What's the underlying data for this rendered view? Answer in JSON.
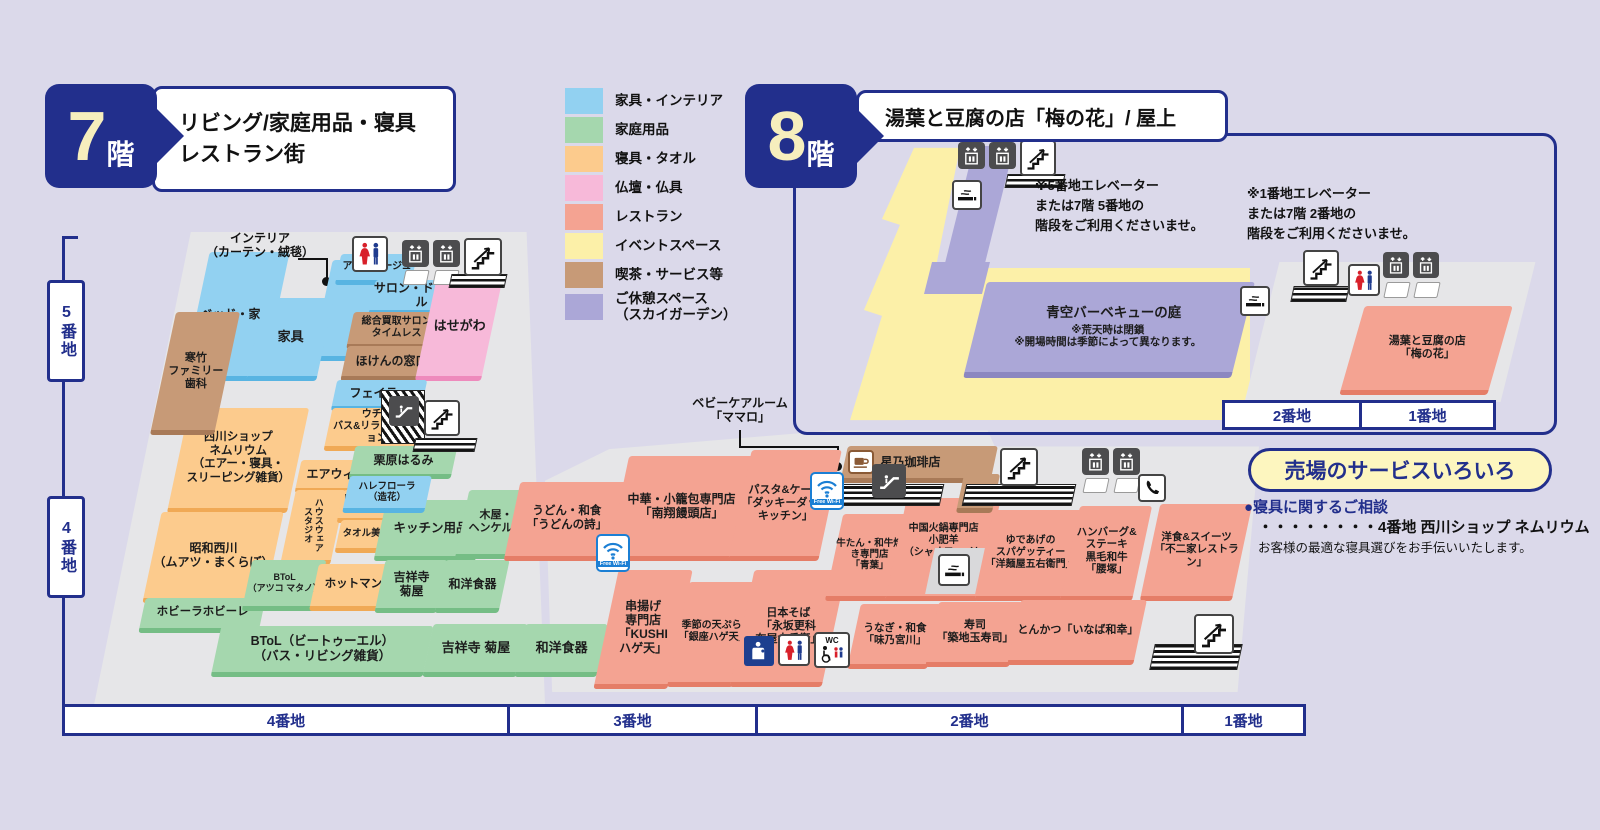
{
  "floor7": {
    "badge": {
      "number": "7",
      "suffix": "階"
    },
    "title_lines": [
      "リビング/家庭用品・寝具",
      "レストラン街"
    ],
    "zones_left": [
      "5番地",
      "4番地"
    ],
    "scale": [
      "4番地",
      "3番地",
      "2番地",
      "1番地"
    ],
    "labels": {
      "interior": [
        "インテリア",
        "（カーテン・絨毯）"
      ],
      "babycare": [
        "ベビーケアルーム",
        "「ママロ」"
      ]
    },
    "shops": [
      {
        "lines": [
          "ベッド・家具"
        ]
      },
      {
        "lines": [
          "寒竹",
          "ファミリー",
          "歯科"
        ]
      },
      {
        "lines": [
          "家具"
        ]
      },
      {
        "lines": [
          "アミブルージュ"
        ]
      },
      {
        "lines": [
          "サロン・ド・アール"
        ]
      },
      {
        "lines": [
          "総合買取サロン",
          "タイムレス"
        ]
      },
      {
        "lines": [
          "ほけんの窓口"
        ]
      },
      {
        "lines": [
          "はせがわ"
        ]
      },
      {
        "lines": [
          "フェイラー"
        ]
      },
      {
        "lines": [
          "ウチノ",
          "バス&リラクゼーション"
        ]
      },
      {
        "lines": [
          "西川ショップ",
          "ネムリウム",
          "（エアー・寝具・",
          "スリーピング雑貨）"
        ]
      },
      {
        "lines": [
          "エアウィーヴ"
        ]
      },
      {
        "lines": [
          "ハウスウェア",
          "スタジオ"
        ]
      },
      {
        "lines": [
          "ロフテー枕工房"
        ]
      },
      {
        "lines": [
          "タオル美術館"
        ]
      },
      {
        "lines": [
          "栗原はるみ"
        ]
      },
      {
        "lines": [
          "ハレフローラ",
          "（造花）"
        ]
      },
      {
        "lines": [
          "キッチン用品"
        ]
      },
      {
        "lines": [
          "木屋・",
          "ヘンケルス"
        ]
      },
      {
        "lines": [
          "昭和西川",
          "（ムアツ・まくらぼ）"
        ]
      },
      {
        "lines": [
          "ホビーラホビーレ"
        ]
      },
      {
        "lines": [
          "BToL",
          "（アツコ マタノ）"
        ]
      },
      {
        "lines": [
          "ホットマン"
        ]
      },
      {
        "lines": [
          "吉祥寺",
          "菊屋"
        ]
      },
      {
        "lines": [
          "和洋食器"
        ]
      },
      {
        "lines": [
          "BToL（ビートゥーエル）",
          "（バス・リビング雑貨）"
        ]
      },
      {
        "lines": [
          "吉祥寺 菊屋"
        ]
      },
      {
        "lines": [
          "和洋食器"
        ]
      },
      {
        "lines": [
          "うどん・和食",
          "「うどんの詩」"
        ]
      },
      {
        "lines": [
          "中華・小籠包専門店",
          "「南翔饅頭店」"
        ]
      },
      {
        "lines": [
          "パスタ&ケーキ",
          "「ダッキーダック",
          "キッチン」"
        ]
      },
      {
        "lines": [
          "串揚げ",
          "専門店",
          "「KUSHI",
          "ハゲ天」"
        ]
      },
      {
        "lines": [
          "季節の天ぷら",
          "「銀座ハゲ天」"
        ]
      },
      {
        "lines": [
          "日本そば",
          "「永坂更科",
          "布屋太兵衛」"
        ]
      },
      {
        "lines": [
          "牛たん・和牛焼き専門店",
          "「青葉」"
        ]
      },
      {
        "lines": [
          "中国火鍋専門店",
          "小肥羊",
          "（シャオフェイヤン）"
        ]
      },
      {
        "lines": [
          "ゆであげの",
          "スパゲッティー",
          "「洋麺屋五右衛門」"
        ]
      },
      {
        "lines": [
          "ハンバーグ&",
          "ステーキ",
          "黒毛和牛",
          "「腰塚」"
        ]
      },
      {
        "lines": [
          "洋食&スイーツ",
          "「不二家レストラン」"
        ]
      },
      {
        "lines": [
          "うなぎ・和食",
          "「味乃宮川」"
        ]
      },
      {
        "lines": [
          "寿司",
          "「築地玉寿司」"
        ]
      },
      {
        "lines": [
          "とんかつ「いなば和幸」"
        ]
      },
      {
        "lines": [
          "星乃珈琲店"
        ]
      }
    ]
  },
  "floor8": {
    "badge": {
      "number": "8",
      "suffix": "階"
    },
    "title": "湯葉と豆腐の店「梅の花」/ 屋上",
    "bbq": {
      "title": "青空バーベキューの庭",
      "notes": [
        "※荒天時は閉鎖",
        "※開場時間は季節によって異なります。"
      ]
    },
    "umenohana": [
      "湯葉と豆腐の店",
      "「梅の花」"
    ],
    "note_5banchi": [
      "※5番地エレベーター",
      "または7階 5番地の",
      "階段をご利用くださいませ。"
    ],
    "note_1banchi": [
      "※1番地エレベーター",
      "または7階 2番地の",
      "階段をご利用くださいませ。"
    ],
    "scale": [
      "2番地",
      "1番地"
    ]
  },
  "legend": {
    "items": [
      {
        "label": "家具・インテリア",
        "color": "#92d1f1"
      },
      {
        "label": "家庭用品",
        "color": "#a5d7ae"
      },
      {
        "label": "寝具・タオル",
        "color": "#fccb8d"
      },
      {
        "label": "仏壇・仏具",
        "color": "#f7b9d9"
      },
      {
        "label": "レストラン",
        "color": "#f4a392"
      },
      {
        "label": "イベントスペース",
        "color": "#fcf0a8"
      },
      {
        "label": "喫茶・サービス等",
        "color": "#c79a77"
      },
      {
        "label": "ご休憩スペース\n（スカイガーデン）",
        "color": "#aba7d7"
      }
    ]
  },
  "service_box": {
    "title": "売場のサービスいろいろ",
    "line1": "●寝具に関するご相談",
    "line2": "・・・・・・・・4番地 西川ショップ ネムリウム",
    "line3": "お客様の最適な寝具選びをお手伝いいたします。"
  },
  "icons": {
    "wifi_label": "Free Wi-Fi",
    "wc_label": "WC",
    "names": [
      "restroom-icon",
      "elevator-icon",
      "stairs-icon",
      "escalator-icon",
      "smoking-icon",
      "coffee-icon",
      "wifi-icon",
      "phone-icon",
      "baby-care-icon",
      "accessible-wc-icon"
    ]
  },
  "colors": {
    "navy": "#222f8c",
    "background": "#dbd9ea",
    "floor": "#e6e6e8",
    "event_yellow": "#fcf0a8"
  }
}
